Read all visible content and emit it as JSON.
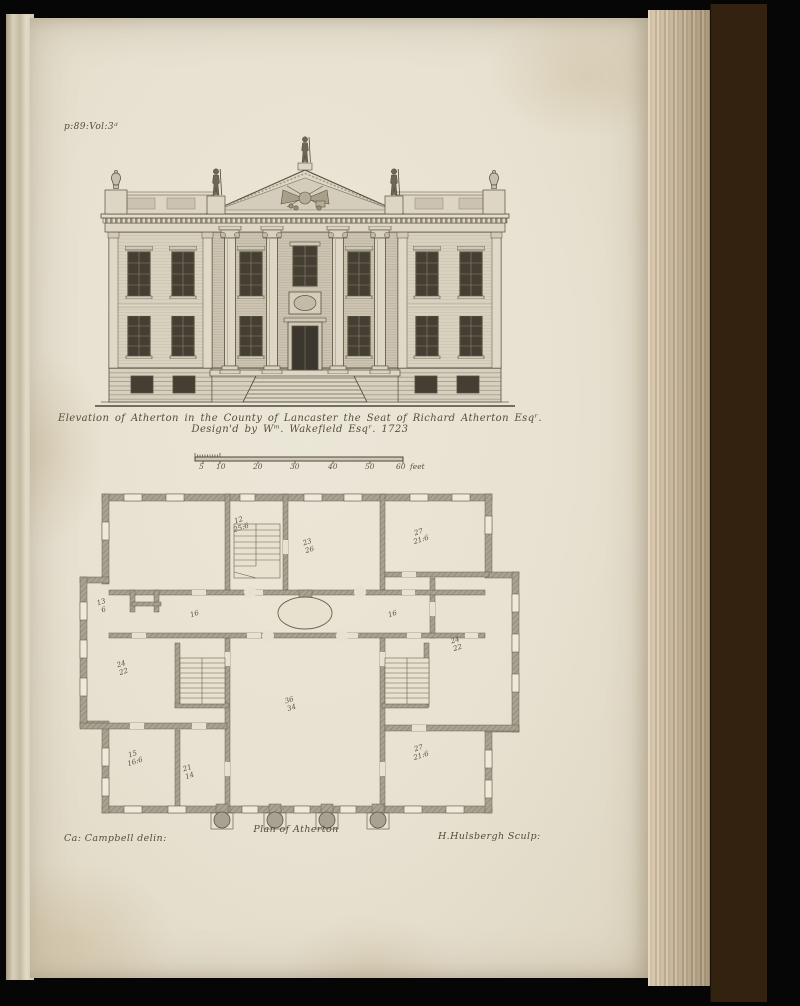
{
  "page": {
    "ref": "p:89:Vol:3ᵈ",
    "paper_color": "#e7e1d1",
    "ink_color": "#544d3b",
    "wall_color": "#a9a191",
    "background_color": "#070707",
    "leather_color": "#33220f"
  },
  "elevation": {
    "caption": "Elevation of Atherton in the County of Lancaster the Seat of Richard Atherton Esqʳ. Design'd by Wᵐ. Wakefield Esqʳ. 1723"
  },
  "scale_bar": {
    "ticks": [
      "5",
      "10",
      "20",
      "30",
      "40",
      "50",
      "60"
    ],
    "unit": "feet"
  },
  "plan": {
    "caption": "Plan of Atherton",
    "rooms": [
      {
        "name": "stair-compartment",
        "number": "12",
        "dim": "25:6"
      },
      {
        "name": "room-top-center",
        "number": "23",
        "dim": "26"
      },
      {
        "name": "room-top-right",
        "number": "27",
        "dim": "21:6"
      },
      {
        "name": "lobby-left",
        "number": "13",
        "dim": "6"
      },
      {
        "name": "passage-left",
        "number": "16",
        "dim": ""
      },
      {
        "name": "passage-right",
        "number": "16",
        "dim": ""
      },
      {
        "name": "room-left-middle",
        "number": "24",
        "dim": "22"
      },
      {
        "name": "great-hall",
        "number": "36",
        "dim": "34"
      },
      {
        "name": "room-right-middle",
        "number": "24",
        "dim": "22"
      },
      {
        "name": "room-bottom-left",
        "number": "15",
        "dim": "16:6"
      },
      {
        "name": "room-bottom-small",
        "number": "21",
        "dim": "14"
      },
      {
        "name": "room-bottom-right",
        "number": "27",
        "dim": "21:6"
      }
    ]
  },
  "credits": {
    "draughtsman": "Ca: Campbell delin:",
    "engraver": "H.Hulsbergh Sculp:"
  }
}
